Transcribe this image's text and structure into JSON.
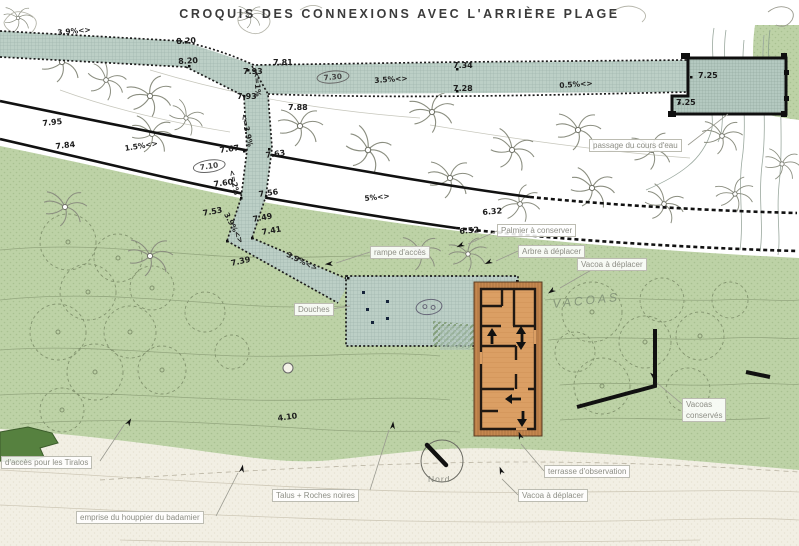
{
  "title": "Croquis des connexions avec l'arrière plage",
  "vacoas_inline": "VACOAS",
  "north_label": "Nord",
  "colors": {
    "vegetation_green": "#bdd2a6",
    "dark_green": "#56813f",
    "walkway_hatch": "#bccfc6",
    "beach_sand": "#f2efe4",
    "building_orange": "#c5874f",
    "building_floor": "#db9f64",
    "ink": "#1c1c1c",
    "label_gray": "#8d8e85"
  },
  "spot_elevations": [
    {
      "t": "8.20",
      "x": 176,
      "y": 37,
      "r": -3
    },
    {
      "t": "8.20",
      "x": 178,
      "y": 57,
      "r": -3
    },
    {
      "t": "7.93",
      "x": 243,
      "y": 67,
      "r": 0
    },
    {
      "t": "7.81",
      "x": 273,
      "y": 58,
      "r": 0
    },
    {
      "t": "7.93",
      "x": 237,
      "y": 92,
      "r": 0
    },
    {
      "t": "7.88",
      "x": 288,
      "y": 103,
      "r": 0
    },
    {
      "t": "7.34",
      "x": 453,
      "y": 61,
      "r": 0
    },
    {
      "t": "7.28",
      "x": 453,
      "y": 84,
      "r": 0
    },
    {
      "t": "7.25",
      "x": 698,
      "y": 71,
      "r": 0
    },
    {
      "t": "7.25",
      "x": 676,
      "y": 98,
      "r": 0
    },
    {
      "t": "7.95",
      "x": 42,
      "y": 119,
      "r": -6
    },
    {
      "t": "7.84",
      "x": 55,
      "y": 142,
      "r": -6
    },
    {
      "t": "7.67",
      "x": 219,
      "y": 146,
      "r": -8
    },
    {
      "t": "7.63",
      "x": 265,
      "y": 151,
      "r": -8
    },
    {
      "t": "7.60",
      "x": 213,
      "y": 180,
      "r": -8
    },
    {
      "t": "7.56",
      "x": 258,
      "y": 190,
      "r": -8
    },
    {
      "t": "7.53",
      "x": 202,
      "y": 209,
      "r": -10
    },
    {
      "t": "7.49",
      "x": 252,
      "y": 215,
      "r": -10
    },
    {
      "t": "7.41",
      "x": 261,
      "y": 228,
      "r": -10
    },
    {
      "t": "7.39",
      "x": 230,
      "y": 259,
      "r": -12
    },
    {
      "t": "6.32",
      "x": 482,
      "y": 208,
      "r": -5
    },
    {
      "t": "6.52",
      "x": 459,
      "y": 227,
      "r": -5
    },
    {
      "t": "4.10",
      "x": 277,
      "y": 414,
      "r": -8
    }
  ],
  "slope_labels": [
    {
      "t": "3.9%<>",
      "x": 57,
      "y": 28,
      "r": -5
    },
    {
      "t": "3.5%<>",
      "x": 374,
      "y": 76,
      "r": -4
    },
    {
      "t": "0.5%<>",
      "x": 559,
      "y": 81,
      "r": -4
    },
    {
      "t": "1.5%<>",
      "x": 124,
      "y": 144,
      "r": -9
    },
    {
      "t": "5%<>",
      "x": 364,
      "y": 194,
      "r": -6
    },
    {
      "t": "<=1%",
      "x": 261,
      "y": 71,
      "r": 86
    },
    {
      "t": "<=3.9%",
      "x": 248,
      "y": 113,
      "r": 78
    },
    {
      "t": "<=2%",
      "x": 236,
      "y": 169,
      "r": 78
    },
    {
      "t": "3.9%<>",
      "x": 230,
      "y": 211,
      "r": 62
    },
    {
      "t": "3.9%<>",
      "x": 289,
      "y": 250,
      "r": 26
    }
  ],
  "circled_elevations": [
    {
      "t": "7.10",
      "x": 192,
      "y": 162,
      "r": -8
    },
    {
      "t": "7.30",
      "x": 316,
      "y": 72,
      "r": -5
    }
  ],
  "callouts": [
    {
      "t": "passage du cours d'eau",
      "x": 589,
      "y": 139
    },
    {
      "t": "rampe d'accès",
      "x": 370,
      "y": 246
    },
    {
      "t": "Douches",
      "x": 294,
      "y": 303
    },
    {
      "t": "Palmier à conserver",
      "x": 497,
      "y": 224
    },
    {
      "t": "Arbre à déplacer",
      "x": 518,
      "y": 245
    },
    {
      "t": "Vacoa à déplacer",
      "x": 577,
      "y": 258
    },
    {
      "t": "Vacoas\nconservés",
      "x": 682,
      "y": 398
    },
    {
      "t": "terrasse d'observation",
      "x": 544,
      "y": 465
    },
    {
      "t": "Vacoa à déplacer",
      "x": 518,
      "y": 489
    },
    {
      "t": "d'accès pour les Tiralos",
      "x": 1,
      "y": 456
    },
    {
      "t": "emprise du houppier du badamier",
      "x": 76,
      "y": 511
    },
    {
      "t": "Talus + Roches noires",
      "x": 272,
      "y": 489
    }
  ]
}
